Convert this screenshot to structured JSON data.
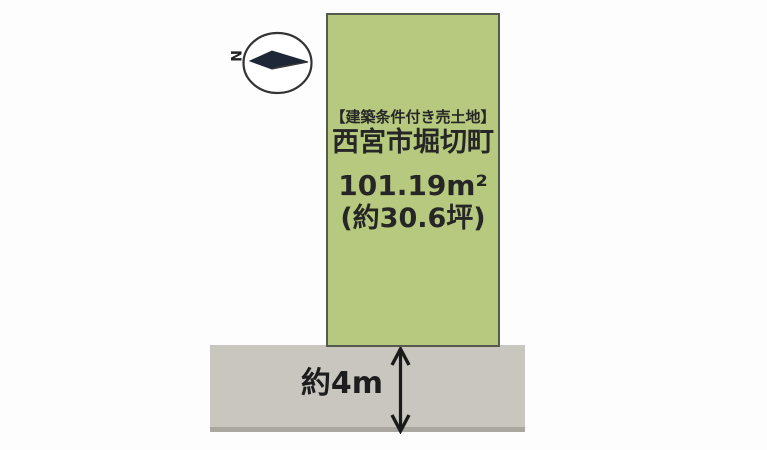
{
  "plot": {
    "condition_tag": "【建築条件付き売土地】",
    "location": "西宮市堀切町",
    "area_sqm": "101.19m²",
    "area_tsubo": "(約30.6坪)"
  },
  "road": {
    "width_label": "約4m"
  },
  "compass": {
    "label": "N"
  },
  "colors": {
    "plot_fill": "#b6c97e",
    "plot_border": "#565a4e",
    "road_fill": "#c9c6c0",
    "road_edge": "#aaa7a1",
    "needle_fill": "#1e2737",
    "text": "#262626"
  }
}
